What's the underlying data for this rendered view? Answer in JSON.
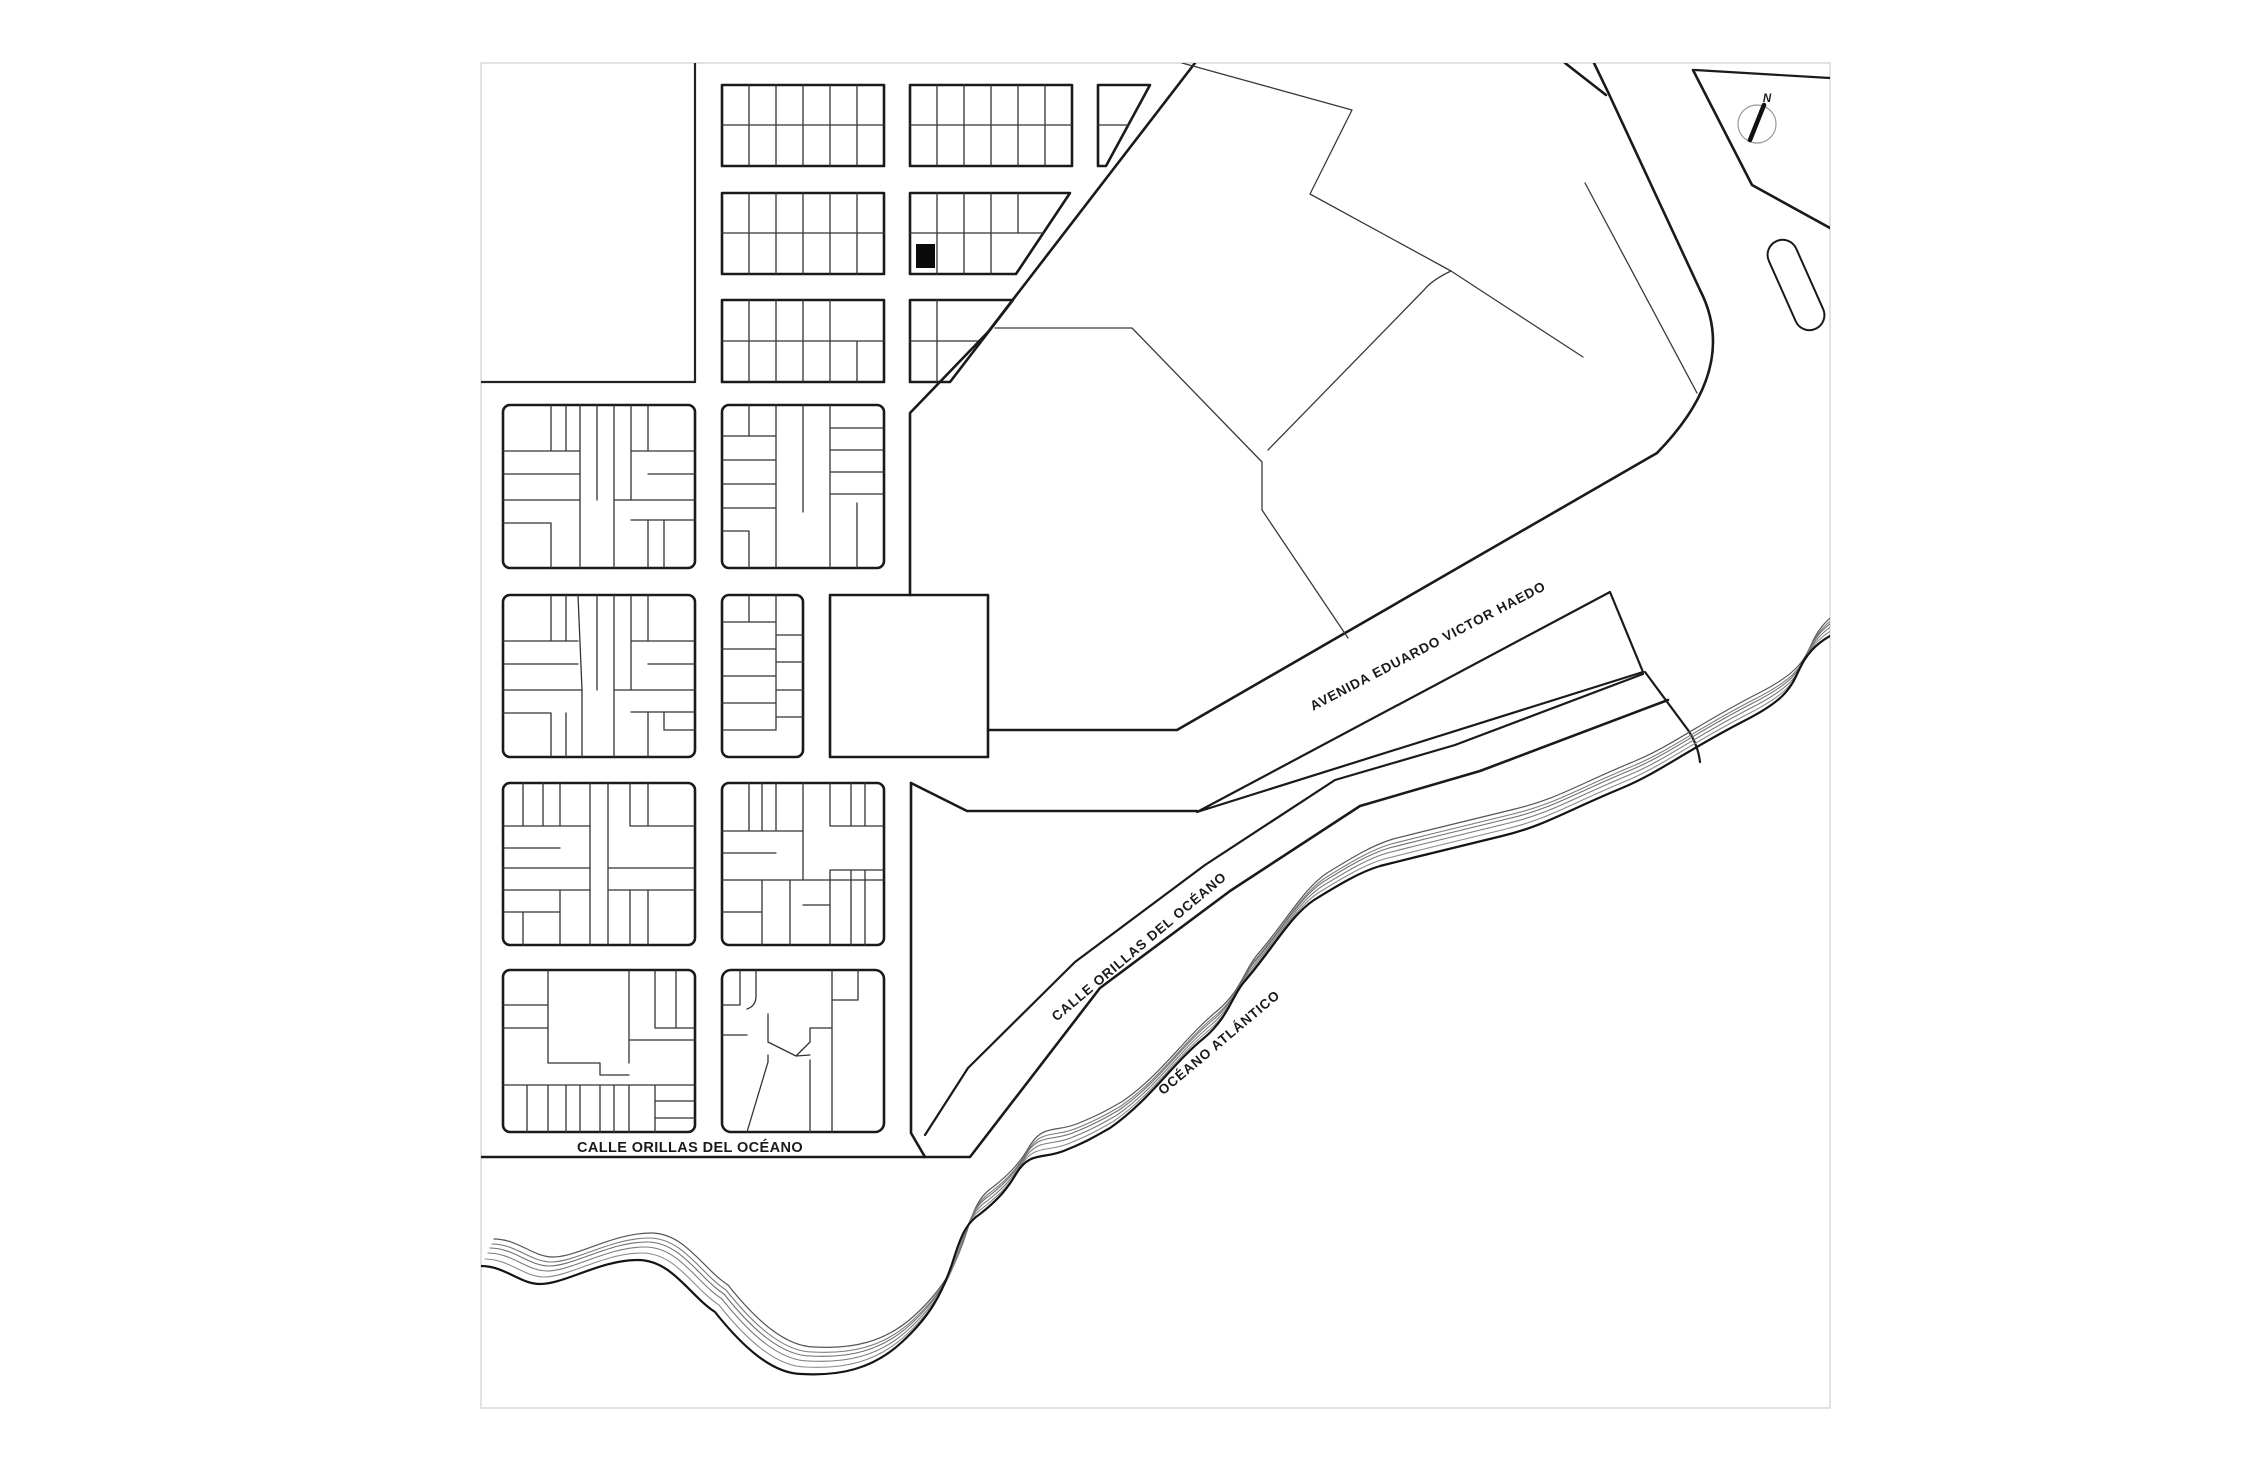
{
  "map": {
    "title": "coastal town site plan",
    "labels": {
      "avenue": "AVENIDA EDUARDO VICTOR HAEDO",
      "coastal_street_diagonal": "CALLE ORILLAS DEL OCÉANO",
      "coastal_street_bottom": "CALLE ORILLAS DEL OCÉANO",
      "ocean": "OCÉANO ATLÁNTICO",
      "compass_north": "N"
    },
    "colors": {
      "ink": "#1a1a1a",
      "lot_line": "#333333",
      "frame": "#d9d9d9",
      "highlight_fill": "#0a0a0a",
      "contour": "#777777",
      "compass_ring": "#999999"
    }
  }
}
